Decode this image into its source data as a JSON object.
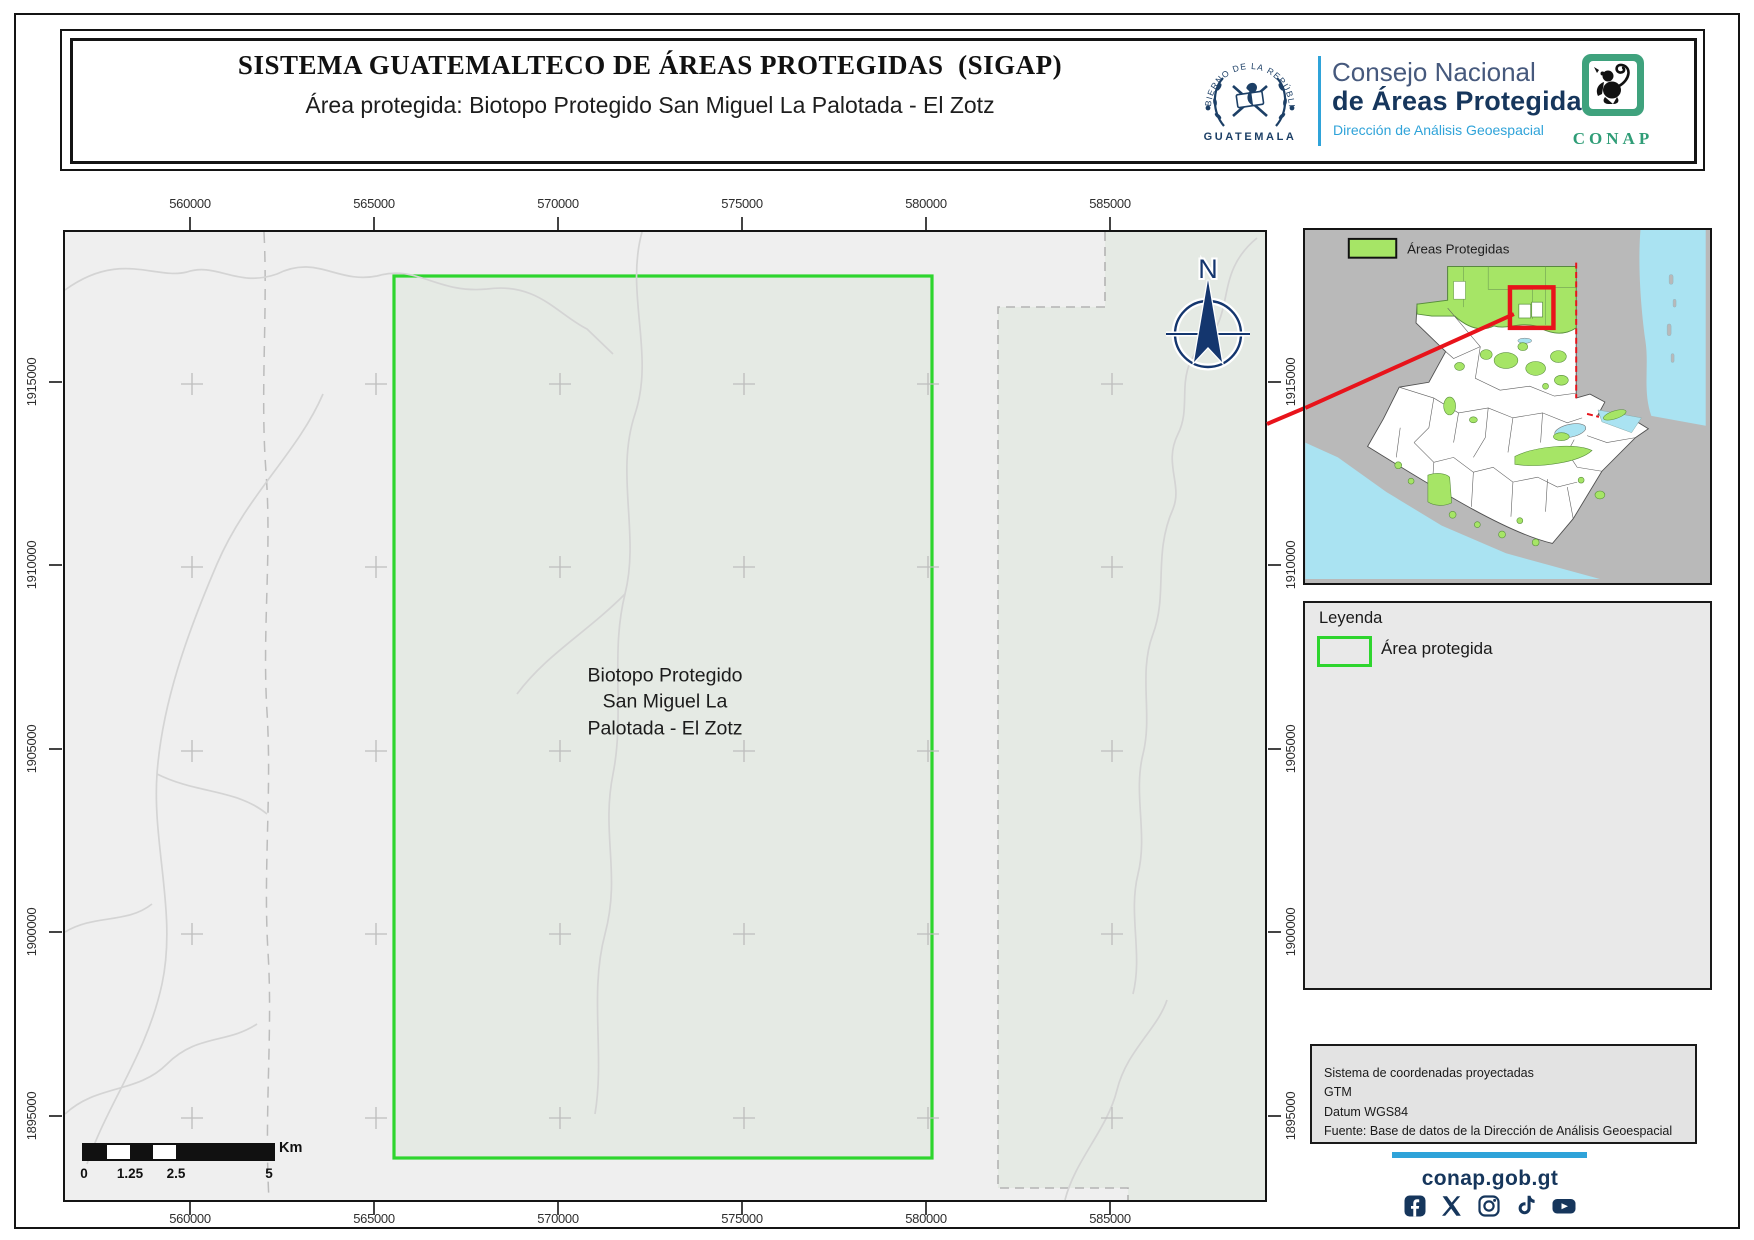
{
  "header": {
    "title": "SISTEMA GUATEMALTECO DE ÁREAS PROTEGIDAS  (SIGAP)",
    "subtitle": "Área protegida: Biotopo Protegido San Miguel La Palotada - El Zotz",
    "emblem": {
      "top_text": "GOBIERNO DE LA REPÚBLICA",
      "bottom_text": "GUATEMALA"
    },
    "org": {
      "line1": "Consejo Nacional",
      "line2": "de Áreas Protegidas",
      "line3": "Dirección de Análisis Geoespacial"
    },
    "conap_logo_text": "CONAP"
  },
  "map": {
    "x_ticks": [
      "560000",
      "565000",
      "570000",
      "575000",
      "580000",
      "585000"
    ],
    "y_ticks": [
      "1915000",
      "1910000",
      "1905000",
      "1900000",
      "1895000"
    ],
    "area_label": "Biotopo Protegido\nSan Miguel La\nPalotada - El Zotz",
    "compass_label": "N",
    "scalebar": {
      "labels": [
        "0",
        "1.25",
        "2.5",
        "5"
      ],
      "unit": "Km"
    }
  },
  "inset": {
    "legend_label": "Áreas Protegidas"
  },
  "legend_panel": {
    "title": "Leyenda",
    "item_label": "Área protegida"
  },
  "info_panel": {
    "lines": [
      "Sistema de coordenadas proyectadas",
      "GTM",
      "Datum WGS84",
      "Fuente: Base de datos de la Dirección de Análisis Geoespacial"
    ]
  },
  "footer": {
    "website": "conap.gob.gt",
    "social_icons": [
      "facebook",
      "x",
      "instagram",
      "tiktok",
      "youtube"
    ]
  },
  "colors": {
    "protected_border_green": "#2ed52e",
    "protected_fill": "#e5eae4",
    "inset_green": "#a6e566",
    "navy": "#16365c",
    "light_blue": "#2fa3d9",
    "red": "#e8131b"
  }
}
